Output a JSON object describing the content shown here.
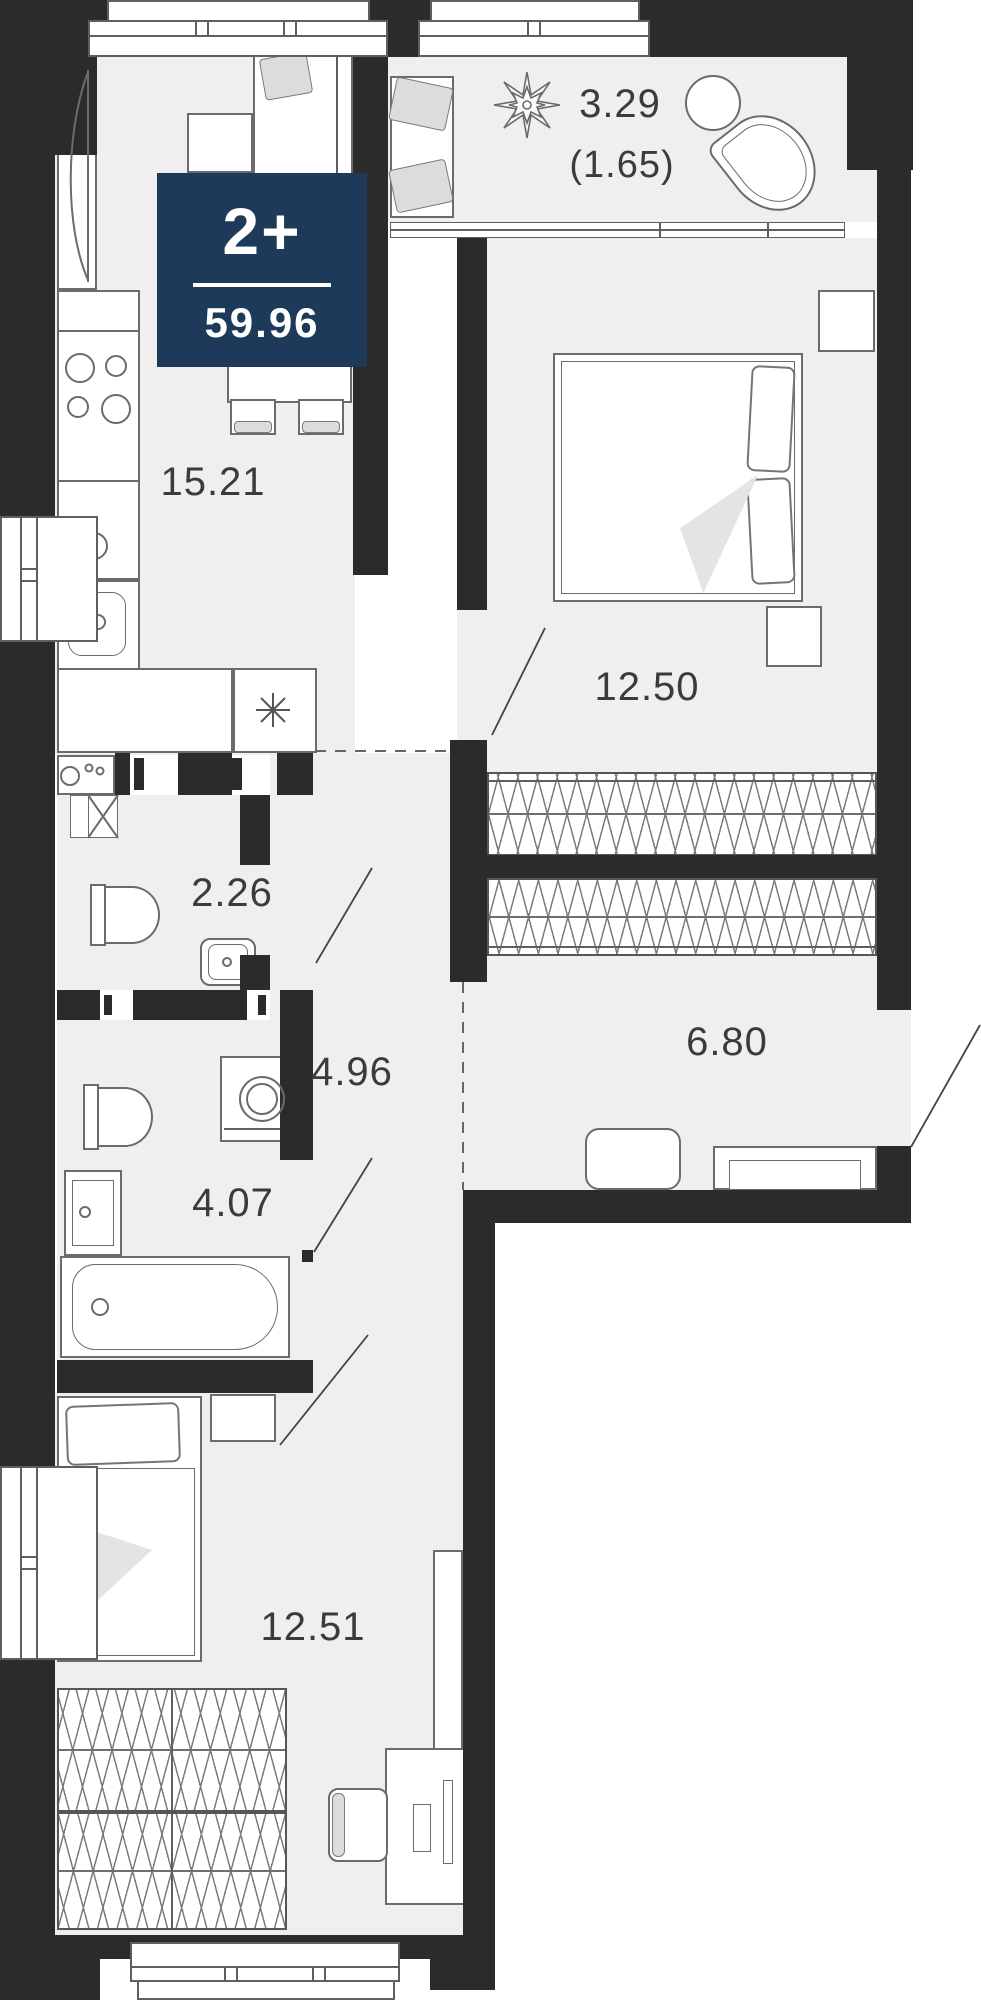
{
  "plan": {
    "badge": {
      "rooms": "2+",
      "total_area": "59.96",
      "color": "#1e3a5a"
    },
    "rooms": [
      {
        "id": "kitchen-living",
        "area": "15.21"
      },
      {
        "id": "loggia",
        "area": "3.29",
        "area_coefficient": "(1.65)"
      },
      {
        "id": "bedroom-1",
        "area": "12.50"
      },
      {
        "id": "wc",
        "area": "2.26"
      },
      {
        "id": "corridor",
        "area": "4.96"
      },
      {
        "id": "hall",
        "area": "6.80"
      },
      {
        "id": "bathroom",
        "area": "4.07"
      },
      {
        "id": "bedroom-2",
        "area": "12.51"
      }
    ],
    "colors": {
      "wall": "#2b2b2b",
      "floor": "#efefef",
      "badge": "#1e3a5a",
      "stroke": "#6b6b6b",
      "text": "#3b3b3b"
    },
    "icons": {
      "refrigerator": "asterisk-icon",
      "plant": "plant-icon",
      "ventilation": "x-box-icon"
    }
  }
}
